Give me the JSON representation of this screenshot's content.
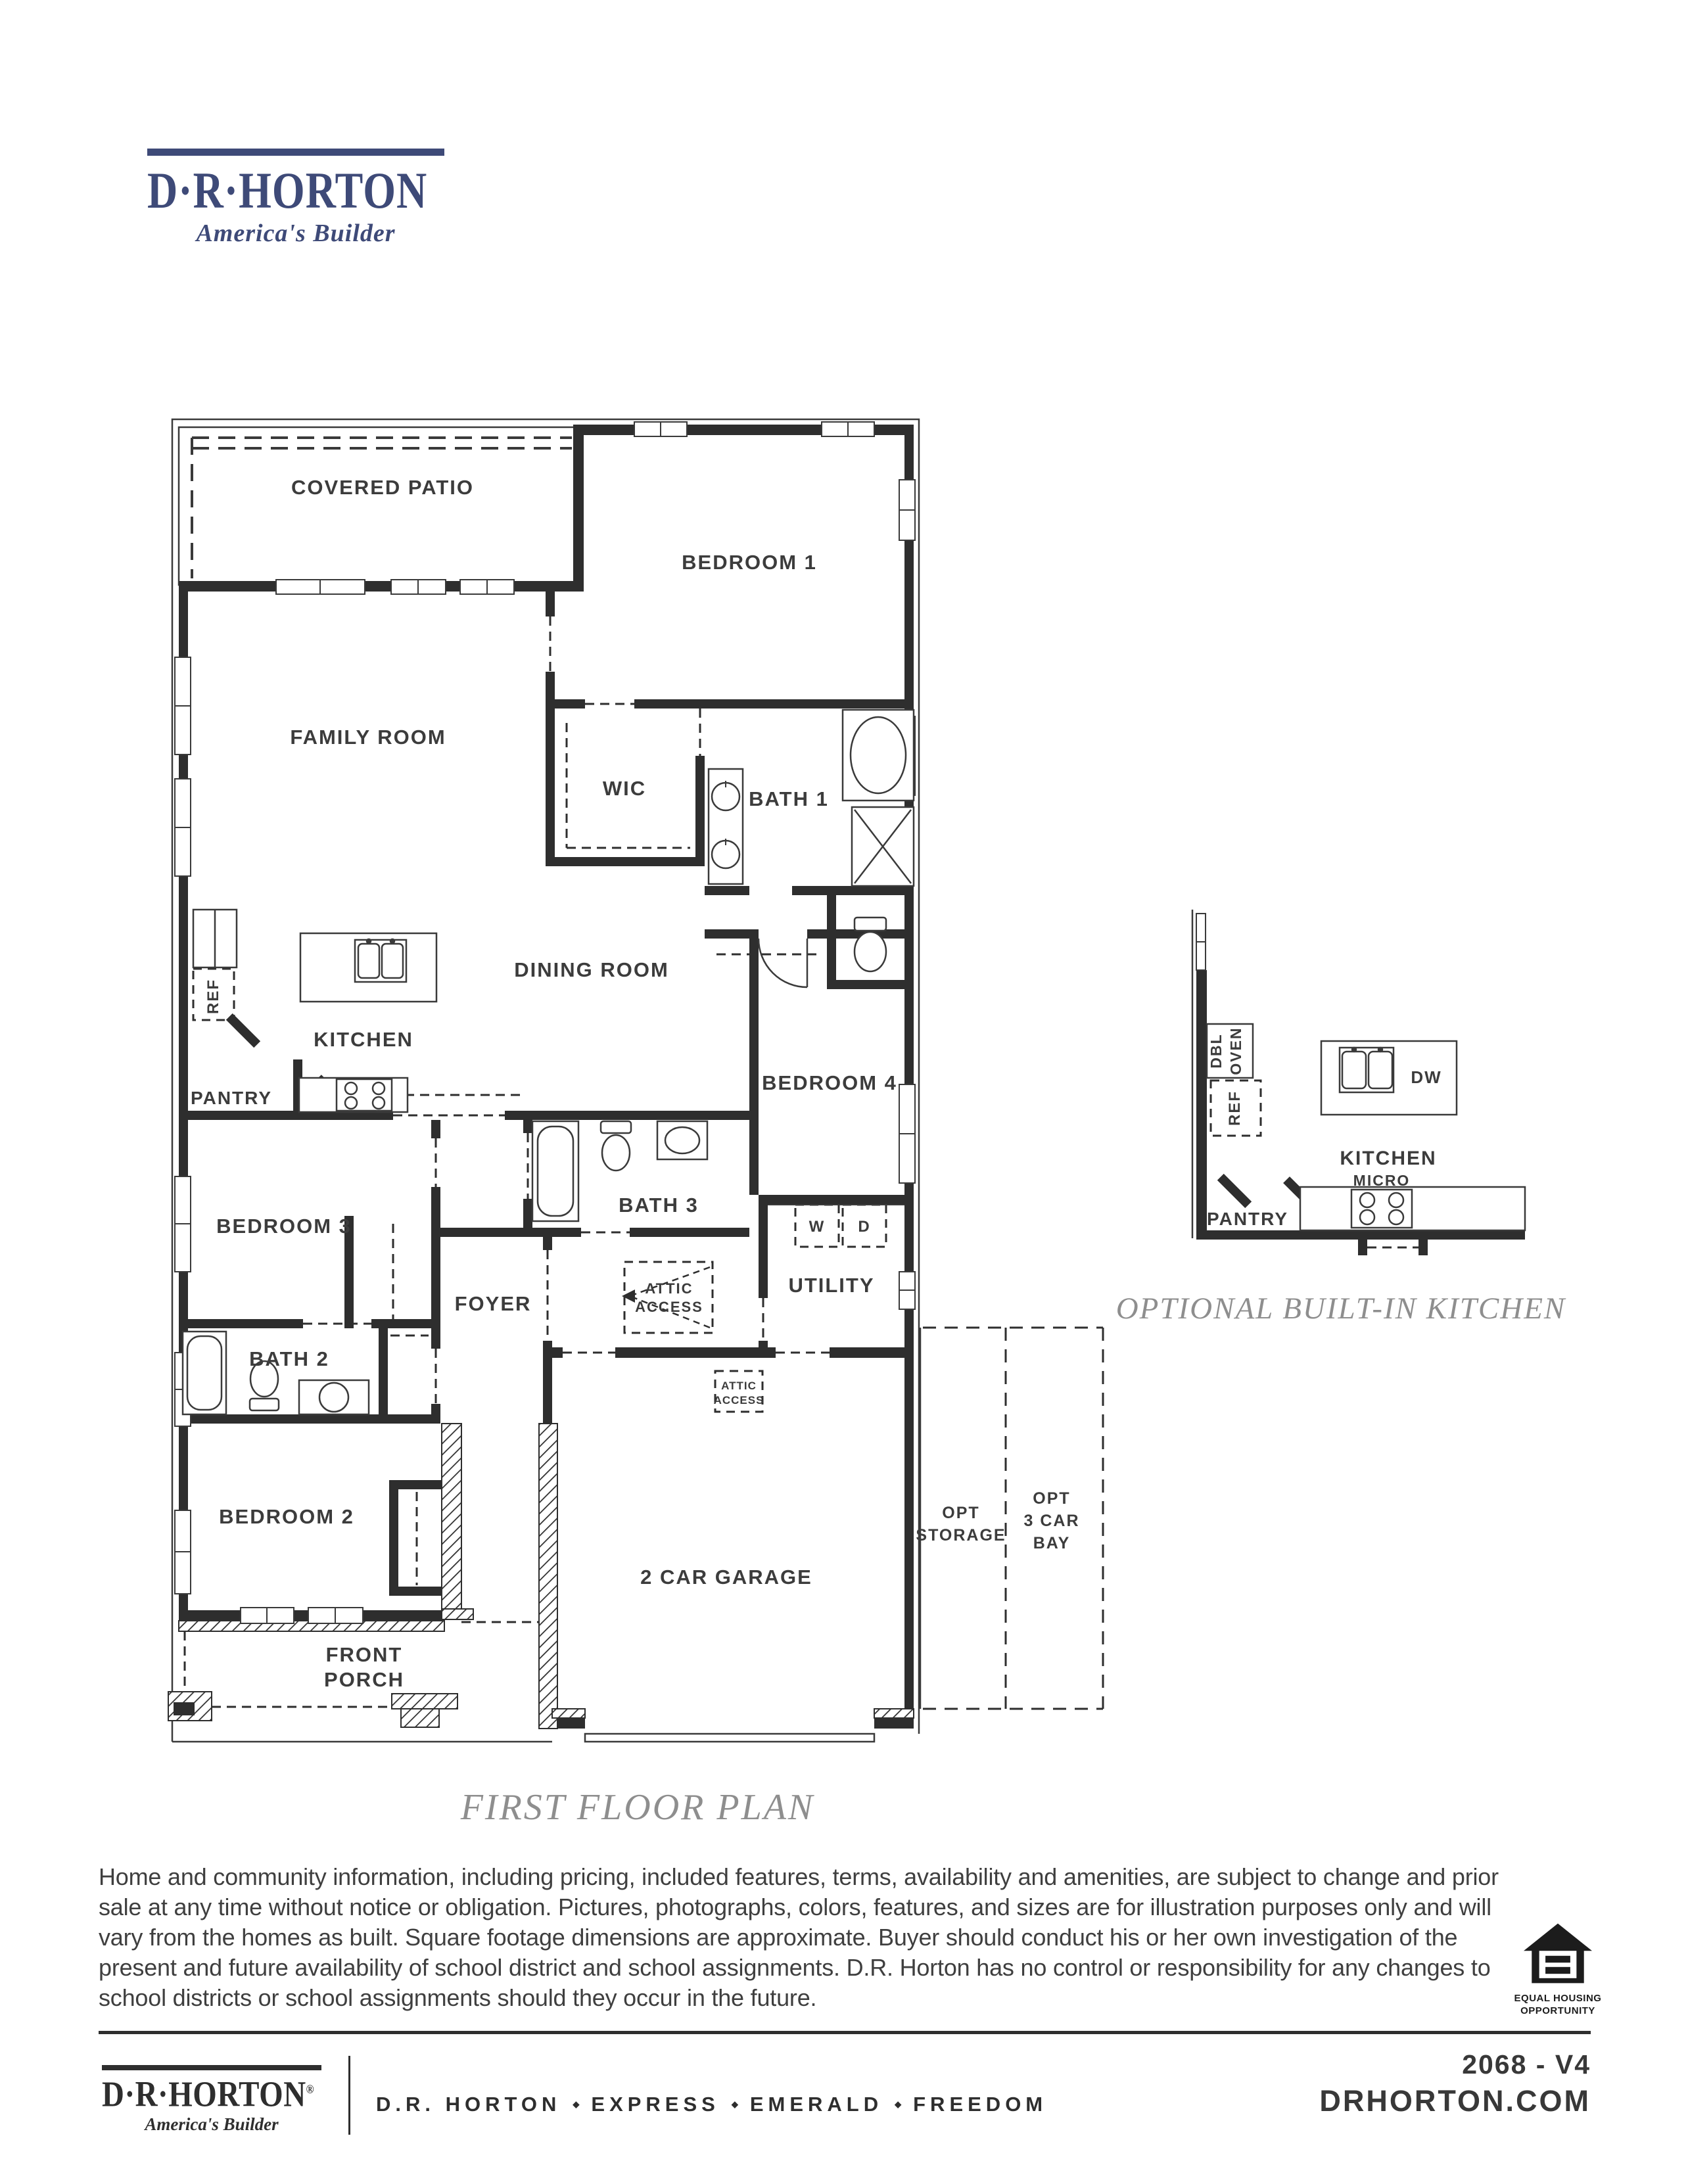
{
  "logo": {
    "name": "D·R·HORTON",
    "registered": "®",
    "tagline": "America's Builder"
  },
  "plan": {
    "labels": {
      "covered_patio": "COVERED PATIO",
      "bedroom1": "BEDROOM 1",
      "family_room": "FAMILY ROOM",
      "wic": "WIC",
      "bath1": "BATH 1",
      "dining_room": "DINING ROOM",
      "kitchen": "KITCHEN",
      "pantry": "PANTRY",
      "ref": "REF",
      "bedroom4": "BEDROOM 4",
      "bath3": "BATH 3",
      "bedroom3": "BEDROOM 3",
      "foyer": "FOYER",
      "utility": "UTILITY",
      "washer": "W",
      "dryer": "D",
      "attic_line1": "ATTIC",
      "attic_line2": "ACCESS",
      "bath2": "BATH 2",
      "bedroom2": "BEDROOM 2",
      "front_porch_line1": "FRONT",
      "front_porch_line2": "PORCH",
      "garage": "2 CAR GARAGE",
      "opt_storage_line1": "OPT",
      "opt_storage_line2": "STORAGE",
      "opt_bay_line1": "OPT",
      "opt_bay_line2": "3 CAR",
      "opt_bay_line3": "BAY"
    },
    "optional_kitchen": {
      "dbl_oven_line1": "DBL",
      "dbl_oven_line2": "OVEN",
      "ref": "REF",
      "dw": "DW",
      "kitchen": "KITCHEN",
      "micro": "MICRO",
      "pantry": "PANTRY",
      "caption": "OPTIONAL BUILT-IN KITCHEN"
    },
    "caption": "FIRST FLOOR PLAN"
  },
  "disclaimer": "Home and community information, including pricing, included features, terms, availability and amenities, are subject to change and prior sale at any time without notice or obligation. Pictures, photographs, colors, features, and sizes are for illustration purposes only and will vary from the homes as built.  Square footage dimensions are approximate. Buyer should conduct his or her own investigation of the present and future availability of school district and school assignments.  D.R. Horton has no control or responsibility for any changes to school districts or school assignments should they occur in the future.",
  "equal_housing": {
    "line1": "EQUAL HOUSING",
    "line2": "OPPORTUNITY"
  },
  "footer": {
    "logo_name": "D·R·HORTON",
    "logo_registered": "®",
    "logo_tagline": "America's Builder",
    "brands": [
      "D.R. HORTON",
      "EXPRESS",
      "EMERALD",
      "FREEDOM"
    ],
    "separator_icon": "◆",
    "plan_code": "2068 - V4",
    "website": "DRHORTON.COM"
  },
  "colors": {
    "brand_navy": "#3e4a78",
    "ink": "#2e2e2e",
    "caption_gray": "#8e8e8e"
  }
}
